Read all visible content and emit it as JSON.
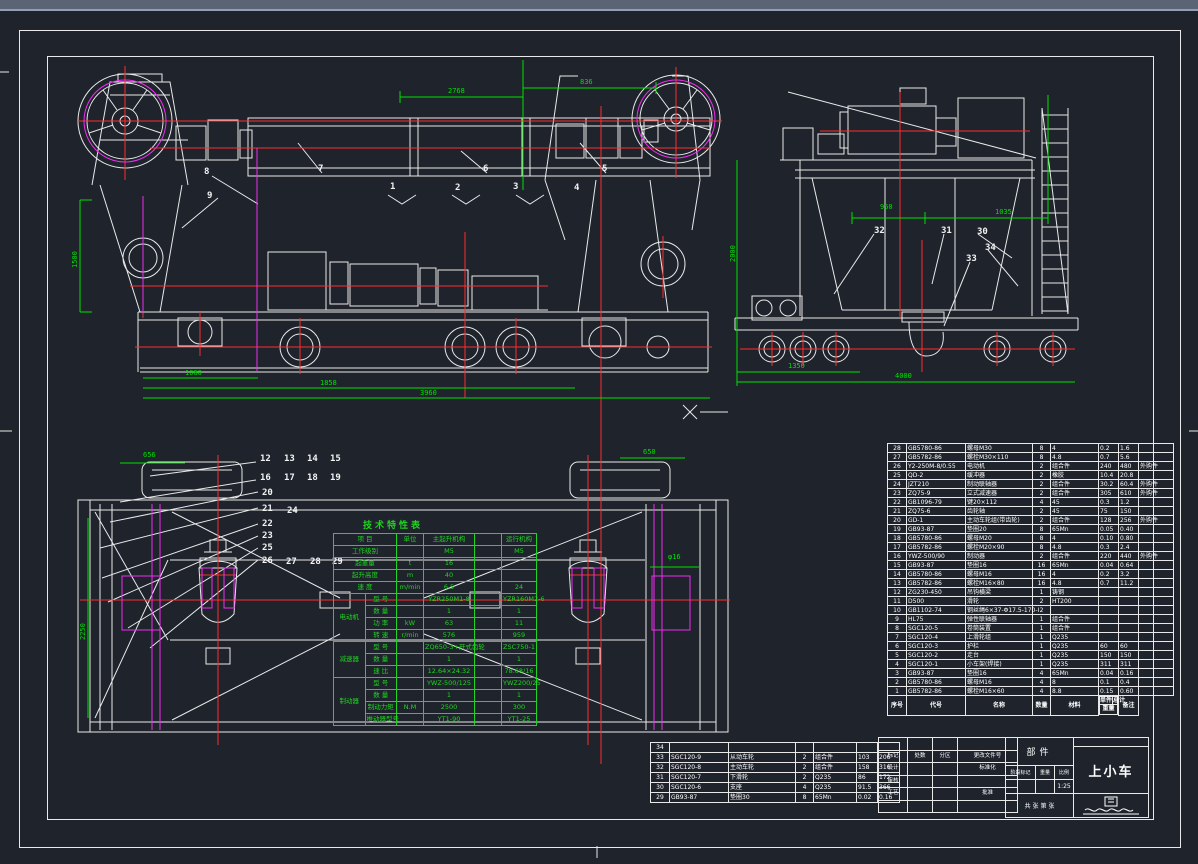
{
  "sheet": {
    "kind_label": "部件",
    "name": "上小车"
  },
  "tech_table": {
    "title": "技术特性表",
    "header": {
      "item": "项 目",
      "unit": "单位",
      "main": "主起升机构",
      "aux": "",
      "travel": "运行机构"
    },
    "rows": [
      {
        "group": "",
        "item": "工作级别",
        "unit": "",
        "main": "M5",
        "aux": "",
        "travel": "M5"
      },
      {
        "group": "",
        "item": "起重量",
        "unit": "t",
        "main": "16",
        "aux": "",
        "travel": ""
      },
      {
        "group": "",
        "item": "起升高度",
        "unit": "m",
        "main": "40",
        "aux": "",
        "travel": ""
      },
      {
        "group": "",
        "item": "速 度",
        "unit": "m/min",
        "main": "6.5",
        "aux": "",
        "travel": "24"
      },
      {
        "group": "电动机",
        "item": "型 号",
        "unit": "",
        "main": "YZR250M1-8",
        "aux": "",
        "travel": "YZR160M2-6"
      },
      {
        "group": "电动机",
        "item": "数 量",
        "unit": "",
        "main": "1",
        "aux": "",
        "travel": "1"
      },
      {
        "group": "电动机",
        "item": "功 率",
        "unit": "kW",
        "main": "63",
        "aux": "",
        "travel": "11"
      },
      {
        "group": "电动机",
        "item": "转 速",
        "unit": "r/min",
        "main": "576",
        "aux": "",
        "travel": "959"
      },
      {
        "group": "减速器",
        "item": "型 号",
        "unit": "",
        "main": "ZQ650-3+开式齿轮",
        "aux": "",
        "travel": "ZSC750-1"
      },
      {
        "group": "减速器",
        "item": "数 量",
        "unit": "",
        "main": "1",
        "aux": "",
        "travel": "1"
      },
      {
        "group": "减速器",
        "item": "速 比",
        "unit": "",
        "main": "12.64×24.32",
        "aux": "",
        "travel": "78.68/16"
      },
      {
        "group": "制动器",
        "item": "型 号",
        "unit": "",
        "main": "YWZ-500/125",
        "aux": "",
        "travel": "YWZ200/25"
      },
      {
        "group": "制动器",
        "item": "数 量",
        "unit": "",
        "main": "1",
        "aux": "",
        "travel": "1"
      },
      {
        "group": "制动器",
        "item": "制动力矩",
        "unit": "N.M",
        "main": "2500",
        "aux": "",
        "travel": "300"
      },
      {
        "group": "制动器",
        "item": "推动器型号",
        "unit": "",
        "main": "YT1-90",
        "aux": "",
        "travel": "YT1-25"
      }
    ]
  },
  "bom": {
    "headers": {
      "no": "序号",
      "code": "代号",
      "name": "名称",
      "qty": "数量",
      "material": "材料",
      "unit_w": "单件",
      "total_w": "总计",
      "weight": "重量",
      "remark": "备注"
    },
    "rows": [
      {
        "no": "28",
        "code": "GB5780-86",
        "name": "螺母M30",
        "qty": "8",
        "material": "4",
        "uw": "0.2",
        "tw": "1.6",
        "remark": ""
      },
      {
        "no": "27",
        "code": "GB5782-86",
        "name": "螺栓M30×110",
        "qty": "8",
        "material": "4.8",
        "uw": "0.7",
        "tw": "5.6",
        "remark": ""
      },
      {
        "no": "26",
        "code": "Y2-250M-8/0.55",
        "name": "电动机",
        "qty": "2",
        "material": "组合件",
        "uw": "240",
        "tw": "480",
        "remark": "外购件"
      },
      {
        "no": "25",
        "code": "QD-2",
        "name": "缓冲器",
        "qty": "2",
        "material": "橡胶",
        "uw": "10.4",
        "tw": "20.8",
        "remark": ""
      },
      {
        "no": "24",
        "code": "JZT210",
        "name": "制动联轴器",
        "qty": "2",
        "material": "组合件",
        "uw": "30.2",
        "tw": "60.4",
        "remark": "外购件"
      },
      {
        "no": "23",
        "code": "ZQ75-9",
        "name": "立式减速器",
        "qty": "2",
        "material": "组合件",
        "uw": "305",
        "tw": "610",
        "remark": "外购件"
      },
      {
        "no": "22",
        "code": "GB1096-79",
        "name": "键20×112",
        "qty": "4",
        "material": "45",
        "uw": "0.3",
        "tw": "1.2",
        "remark": ""
      },
      {
        "no": "21",
        "code": "ZQ75-6",
        "name": "齿轮轴",
        "qty": "2",
        "material": "45",
        "uw": "75",
        "tw": "150",
        "remark": ""
      },
      {
        "no": "20",
        "code": "GD-1",
        "name": "主动车轮组(带齿轮)",
        "qty": "2",
        "material": "组合件",
        "uw": "128",
        "tw": "256",
        "remark": "外购件"
      },
      {
        "no": "19",
        "code": "GB93-87",
        "name": "垫圈20",
        "qty": "8",
        "material": "65Mn",
        "uw": "0.05",
        "tw": "0.40",
        "remark": ""
      },
      {
        "no": "18",
        "code": "GB5780-86",
        "name": "螺母M20",
        "qty": "8",
        "material": "4",
        "uw": "0.10",
        "tw": "0.80",
        "remark": ""
      },
      {
        "no": "17",
        "code": "GB5782-86",
        "name": "螺栓M20×90",
        "qty": "8",
        "material": "4.8",
        "uw": "0.3",
        "tw": "2.4",
        "remark": ""
      },
      {
        "no": "16",
        "code": "YWZ-500/90",
        "name": "制动器",
        "qty": "2",
        "material": "组合件",
        "uw": "220",
        "tw": "440",
        "remark": "外购件"
      },
      {
        "no": "15",
        "code": "GB93-87",
        "name": "垫圈16",
        "qty": "16",
        "material": "65Mn",
        "uw": "0.04",
        "tw": "0.64",
        "remark": ""
      },
      {
        "no": "14",
        "code": "GB5780-86",
        "name": "螺母M16",
        "qty": "16",
        "material": "4",
        "uw": "0.2",
        "tw": "3.2",
        "remark": ""
      },
      {
        "no": "13",
        "code": "GB5782-86",
        "name": "螺栓M16×80",
        "qty": "16",
        "material": "4.8",
        "uw": "0.7",
        "tw": "11.2",
        "remark": ""
      },
      {
        "no": "12",
        "code": "ZG230-450",
        "name": "吊钩横梁",
        "qty": "1",
        "material": "铸钢",
        "uw": "",
        "tw": "",
        "remark": ""
      },
      {
        "no": "11",
        "code": "D500",
        "name": "滑轮",
        "qty": "2",
        "material": "HT200",
        "uw": "",
        "tw": "",
        "remark": ""
      },
      {
        "no": "10",
        "code": "GB1102-74",
        "name": "钢丝绳6×37-Φ17.5-170-I",
        "qty": "2",
        "material": "",
        "uw": "",
        "tw": "",
        "remark": ""
      },
      {
        "no": "9",
        "code": "HL75",
        "name": "弹性联轴器",
        "qty": "1",
        "material": "组合件",
        "uw": "",
        "tw": "",
        "remark": ""
      },
      {
        "no": "8",
        "code": "SGC120-5",
        "name": "卷筒装置",
        "qty": "1",
        "material": "组合件",
        "uw": "",
        "tw": "",
        "remark": ""
      },
      {
        "no": "7",
        "code": "SGC120-4",
        "name": "上滑轮组",
        "qty": "1",
        "material": "Q235",
        "uw": "",
        "tw": "",
        "remark": ""
      },
      {
        "no": "6",
        "code": "SGC120-3",
        "name": "护栏",
        "qty": "1",
        "material": "Q235",
        "uw": "60",
        "tw": "60",
        "remark": ""
      },
      {
        "no": "5",
        "code": "SGC120-2",
        "name": "走台",
        "qty": "1",
        "material": "Q235",
        "uw": "150",
        "tw": "150",
        "remark": ""
      },
      {
        "no": "4",
        "code": "SGC120-1",
        "name": "小车架(焊接)",
        "qty": "1",
        "material": "Q235",
        "uw": "311",
        "tw": "311",
        "remark": ""
      },
      {
        "no": "3",
        "code": "GB93-87",
        "name": "垫圈16",
        "qty": "4",
        "material": "65Mn",
        "uw": "0.04",
        "tw": "0.16",
        "remark": ""
      },
      {
        "no": "2",
        "code": "GB5780-86",
        "name": "螺母M16",
        "qty": "4",
        "material": "8",
        "uw": "0.1",
        "tw": "0.4",
        "remark": ""
      },
      {
        "no": "1",
        "code": "GB5782-86",
        "name": "螺栓M16×60",
        "qty": "4",
        "material": "8.8",
        "uw": "0.15",
        "tw": "0.60",
        "remark": ""
      }
    ]
  },
  "bom_ext": {
    "rows": [
      {
        "no": "34",
        "code": "",
        "name": "",
        "qty": "",
        "material": "",
        "uw": "",
        "tw": ""
      },
      {
        "no": "33",
        "code": "SGC120-9",
        "name": "从动车轮",
        "qty": "2",
        "material": "组合件",
        "uw": "103",
        "tw": "206"
      },
      {
        "no": "32",
        "code": "SGC120-8",
        "name": "主动车轮",
        "qty": "2",
        "material": "组合件",
        "uw": "158",
        "tw": "316"
      },
      {
        "no": "31",
        "code": "SGC120-7",
        "name": "下滑轮",
        "qty": "2",
        "material": "Q235",
        "uw": "86",
        "tw": "172"
      },
      {
        "no": "30",
        "code": "SGC120-6",
        "name": "支座",
        "qty": "4",
        "material": "Q235",
        "uw": "91.5",
        "tw": "366"
      },
      {
        "no": "29",
        "code": "GB93-87",
        "name": "垫圈30",
        "qty": "8",
        "material": "65Mn",
        "uw": "0.02",
        "tw": "0.16"
      }
    ]
  },
  "title_block": {
    "part_label": "部件",
    "name": "上小车",
    "revision_header": [
      "标记",
      "处数",
      "分区",
      "更改文件号"
    ],
    "sign_rows": [
      [
        "设计",
        "标准化"
      ],
      [
        "审核",
        ""
      ],
      [
        "工艺",
        "批准"
      ]
    ],
    "stage_label": "阶段标记",
    "weight_label": "重量",
    "scale_label": "比例",
    "scale_value": "1:25",
    "sheet_count_label": "共 张 第 张"
  },
  "drawing": {
    "callouts": [
      {
        "t": "1",
        "x": 390,
        "y": 183
      },
      {
        "t": "2",
        "x": 455,
        "y": 184
      },
      {
        "t": "3",
        "x": 513,
        "y": 183
      },
      {
        "t": "4",
        "x": 574,
        "y": 184
      },
      {
        "t": "5",
        "x": 602,
        "y": 165
      },
      {
        "t": "6",
        "x": 483,
        "y": 165
      },
      {
        "t": "7",
        "x": 318,
        "y": 165
      },
      {
        "t": "8",
        "x": 204,
        "y": 168
      },
      {
        "t": "9",
        "x": 207,
        "y": 192
      },
      {
        "t": "30",
        "x": 977,
        "y": 228
      },
      {
        "t": "31",
        "x": 941,
        "y": 227
      },
      {
        "t": "32",
        "x": 874,
        "y": 227
      },
      {
        "t": "33",
        "x": 966,
        "y": 255
      },
      {
        "t": "34",
        "x": 985,
        "y": 244
      },
      {
        "t": "12",
        "x": 260,
        "y": 455
      },
      {
        "t": "13",
        "x": 284,
        "y": 455
      },
      {
        "t": "14",
        "x": 307,
        "y": 455
      },
      {
        "t": "15",
        "x": 330,
        "y": 455
      },
      {
        "t": "16",
        "x": 260,
        "y": 474
      },
      {
        "t": "17",
        "x": 284,
        "y": 474
      },
      {
        "t": "18",
        "x": 307,
        "y": 474
      },
      {
        "t": "19",
        "x": 330,
        "y": 474
      },
      {
        "t": "20",
        "x": 262,
        "y": 489
      },
      {
        "t": "21",
        "x": 262,
        "y": 505
      },
      {
        "t": "24",
        "x": 287,
        "y": 507
      },
      {
        "t": "22",
        "x": 262,
        "y": 520
      },
      {
        "t": "23",
        "x": 262,
        "y": 532
      },
      {
        "t": "25",
        "x": 262,
        "y": 544
      },
      {
        "t": "26",
        "x": 262,
        "y": 557
      },
      {
        "t": "27",
        "x": 286,
        "y": 558
      },
      {
        "t": "28",
        "x": 310,
        "y": 558
      },
      {
        "t": "29",
        "x": 332,
        "y": 558
      }
    ],
    "dimensions": [
      {
        "t": "2768",
        "x": 448,
        "y": 88,
        "rot": false
      },
      {
        "t": "836",
        "x": 580,
        "y": 79,
        "rot": false
      },
      {
        "t": "1060",
        "x": 185,
        "y": 370,
        "rot": false
      },
      {
        "t": "1858",
        "x": 320,
        "y": 380,
        "rot": false
      },
      {
        "t": "3960",
        "x": 420,
        "y": 390,
        "rot": false
      },
      {
        "t": "1500",
        "x": 72,
        "y": 268,
        "rot": true
      },
      {
        "t": "950",
        "x": 880,
        "y": 204,
        "rot": false
      },
      {
        "t": "1035",
        "x": 995,
        "y": 209,
        "rot": false
      },
      {
        "t": "1350",
        "x": 788,
        "y": 363,
        "rot": false
      },
      {
        "t": "4000",
        "x": 895,
        "y": 373,
        "rot": false
      },
      {
        "t": "2000",
        "x": 730,
        "y": 262,
        "rot": true
      },
      {
        "t": "656",
        "x": 143,
        "y": 452,
        "rot": false
      },
      {
        "t": "650",
        "x": 643,
        "y": 449,
        "rot": false
      },
      {
        "t": "φ16",
        "x": 668,
        "y": 554,
        "rot": false
      },
      {
        "t": "2250",
        "x": 80,
        "y": 640,
        "rot": true
      }
    ]
  }
}
